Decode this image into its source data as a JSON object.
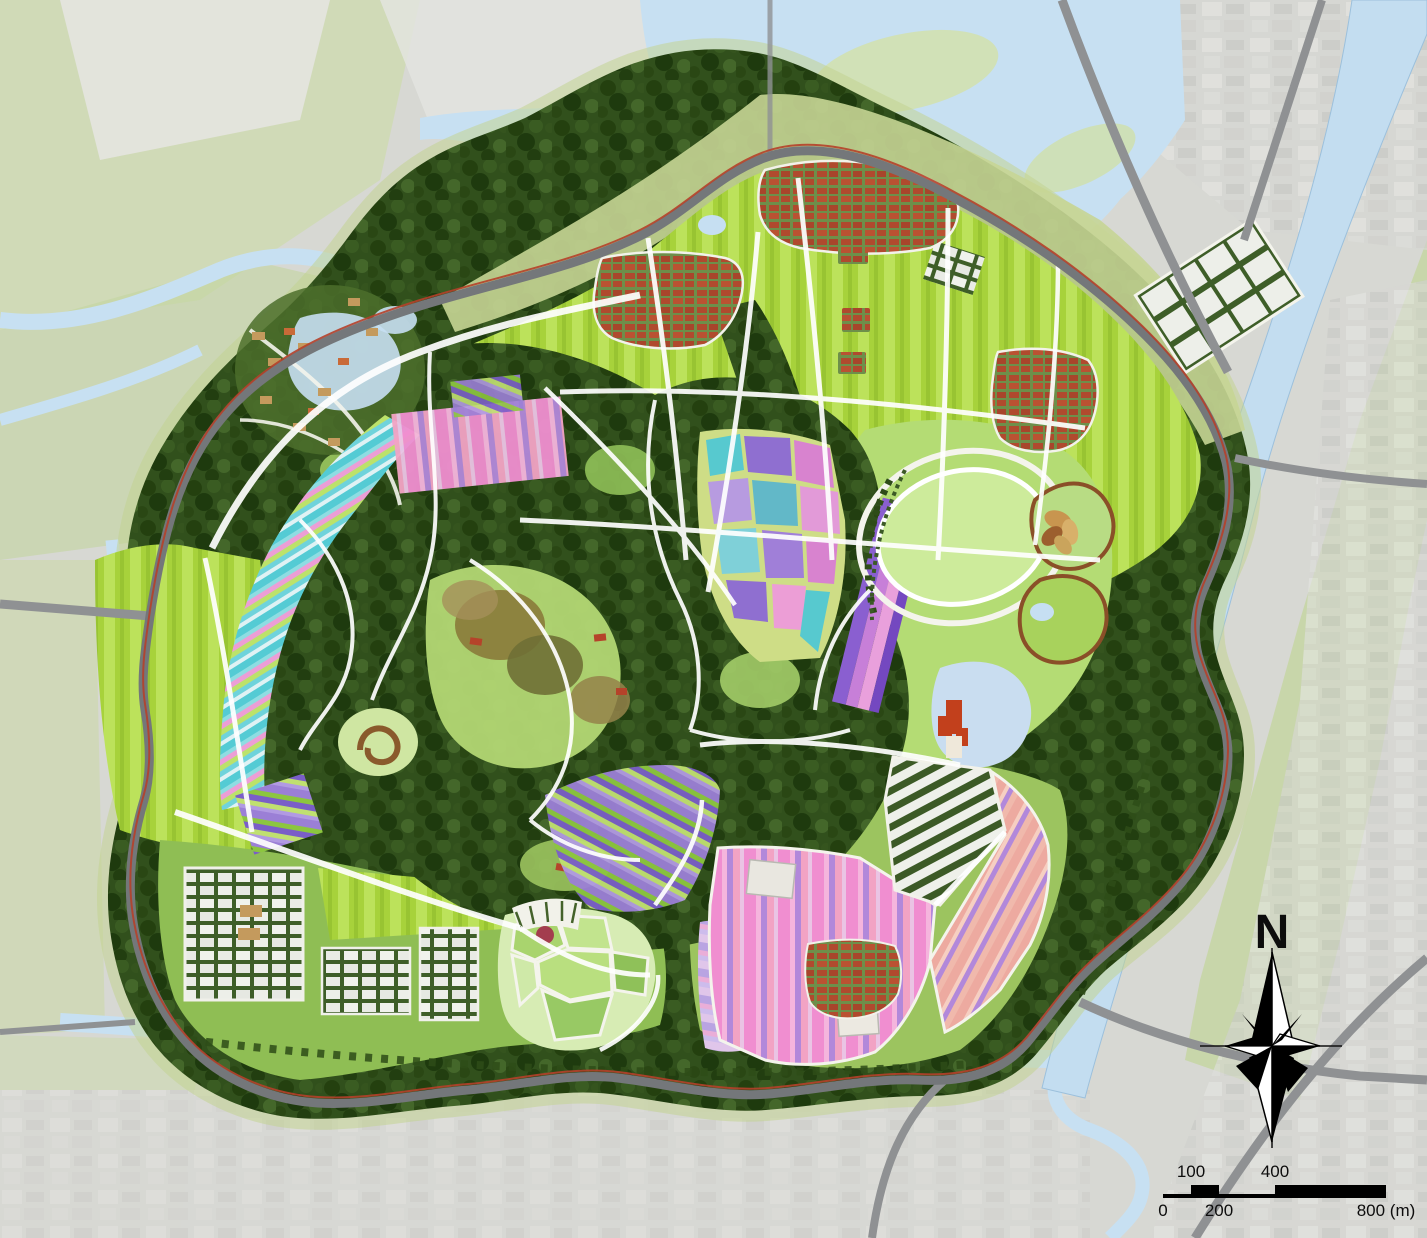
{
  "map": {
    "compass": {
      "label": "N"
    },
    "scale_bar": {
      "t100": "100",
      "t400": "400",
      "b0": "0",
      "b200": "200",
      "b800": "800 (m)"
    },
    "features": [
      {
        "name": "dense-forest-core",
        "color": "#31501c"
      },
      {
        "name": "meadow-farm-fields",
        "color": "#a7d23b"
      },
      {
        "name": "flower-fields-pink",
        "color": "#f08ed0"
      },
      {
        "name": "flower-fields-violet",
        "color": "#b288da"
      },
      {
        "name": "flower-terraces-cyan",
        "color": "#54cbd4"
      },
      {
        "name": "contour-fields-purple-green",
        "color": "#9b7fd6"
      },
      {
        "name": "village-red-roofs",
        "color": "#b04a2e"
      },
      {
        "name": "greenhouses",
        "color": "#edefe9"
      },
      {
        "name": "rivers-and-canal",
        "color": "#c7e0f2"
      },
      {
        "name": "park-ring-road",
        "color": "#74777a"
      },
      {
        "name": "ring-road-accent-line",
        "color": "#b5402a"
      },
      {
        "name": "context-city-blocks",
        "color": "#d6d7d3"
      },
      {
        "name": "context-farmland",
        "color": "#c5d6a2"
      },
      {
        "name": "oval-lawn",
        "color": "#cdeb9b"
      },
      {
        "name": "compass-and-scale",
        "color": "#000000"
      }
    ]
  }
}
